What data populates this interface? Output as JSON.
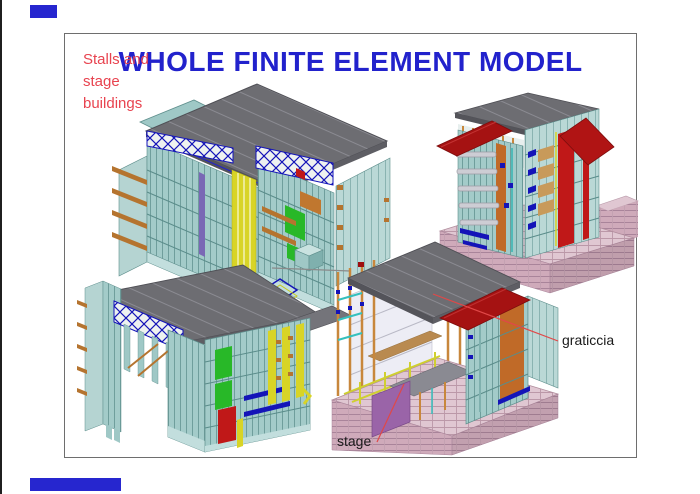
{
  "page": {
    "background": "#ffffff",
    "edge_line_color": "#1f1f1f",
    "accent_bar_color": "#2626cf"
  },
  "figure": {
    "border_color": "#6e6e6e",
    "title": {
      "text": "WHOLE FINITE ELEMENT MODEL",
      "color": "#2222cc"
    },
    "note": {
      "color": "#e8434f",
      "lines": [
        "Stalls and",
        "stage",
        "buildings"
      ]
    },
    "annotations": {
      "graticcia": {
        "text": "graticcia",
        "leader_color": "#e04848"
      },
      "stage": {
        "text": "stage",
        "leader_color": "#e04848"
      }
    },
    "models": {
      "top_left": "stalls-and-stage-buildings-fem-view-1",
      "top_right": "stage-building-fem-with-red-roofs",
      "bottom_left": "stalls-and-stage-buildings-fem-view-2",
      "bottom_right": "stage-building-fem-section-view"
    },
    "palette": {
      "roof_gray": "#6d6d72",
      "wall_teal": "#a3cbc9",
      "truss_blue": "#1414b8",
      "accent_yellow": "#d8d426",
      "accent_green": "#28b828",
      "accent_orange": "#c0772f",
      "accent_red": "#c01818",
      "roof_red": "#a51212",
      "base_pink": "#cfaaba",
      "stage_purple": "#9a64a8"
    }
  }
}
